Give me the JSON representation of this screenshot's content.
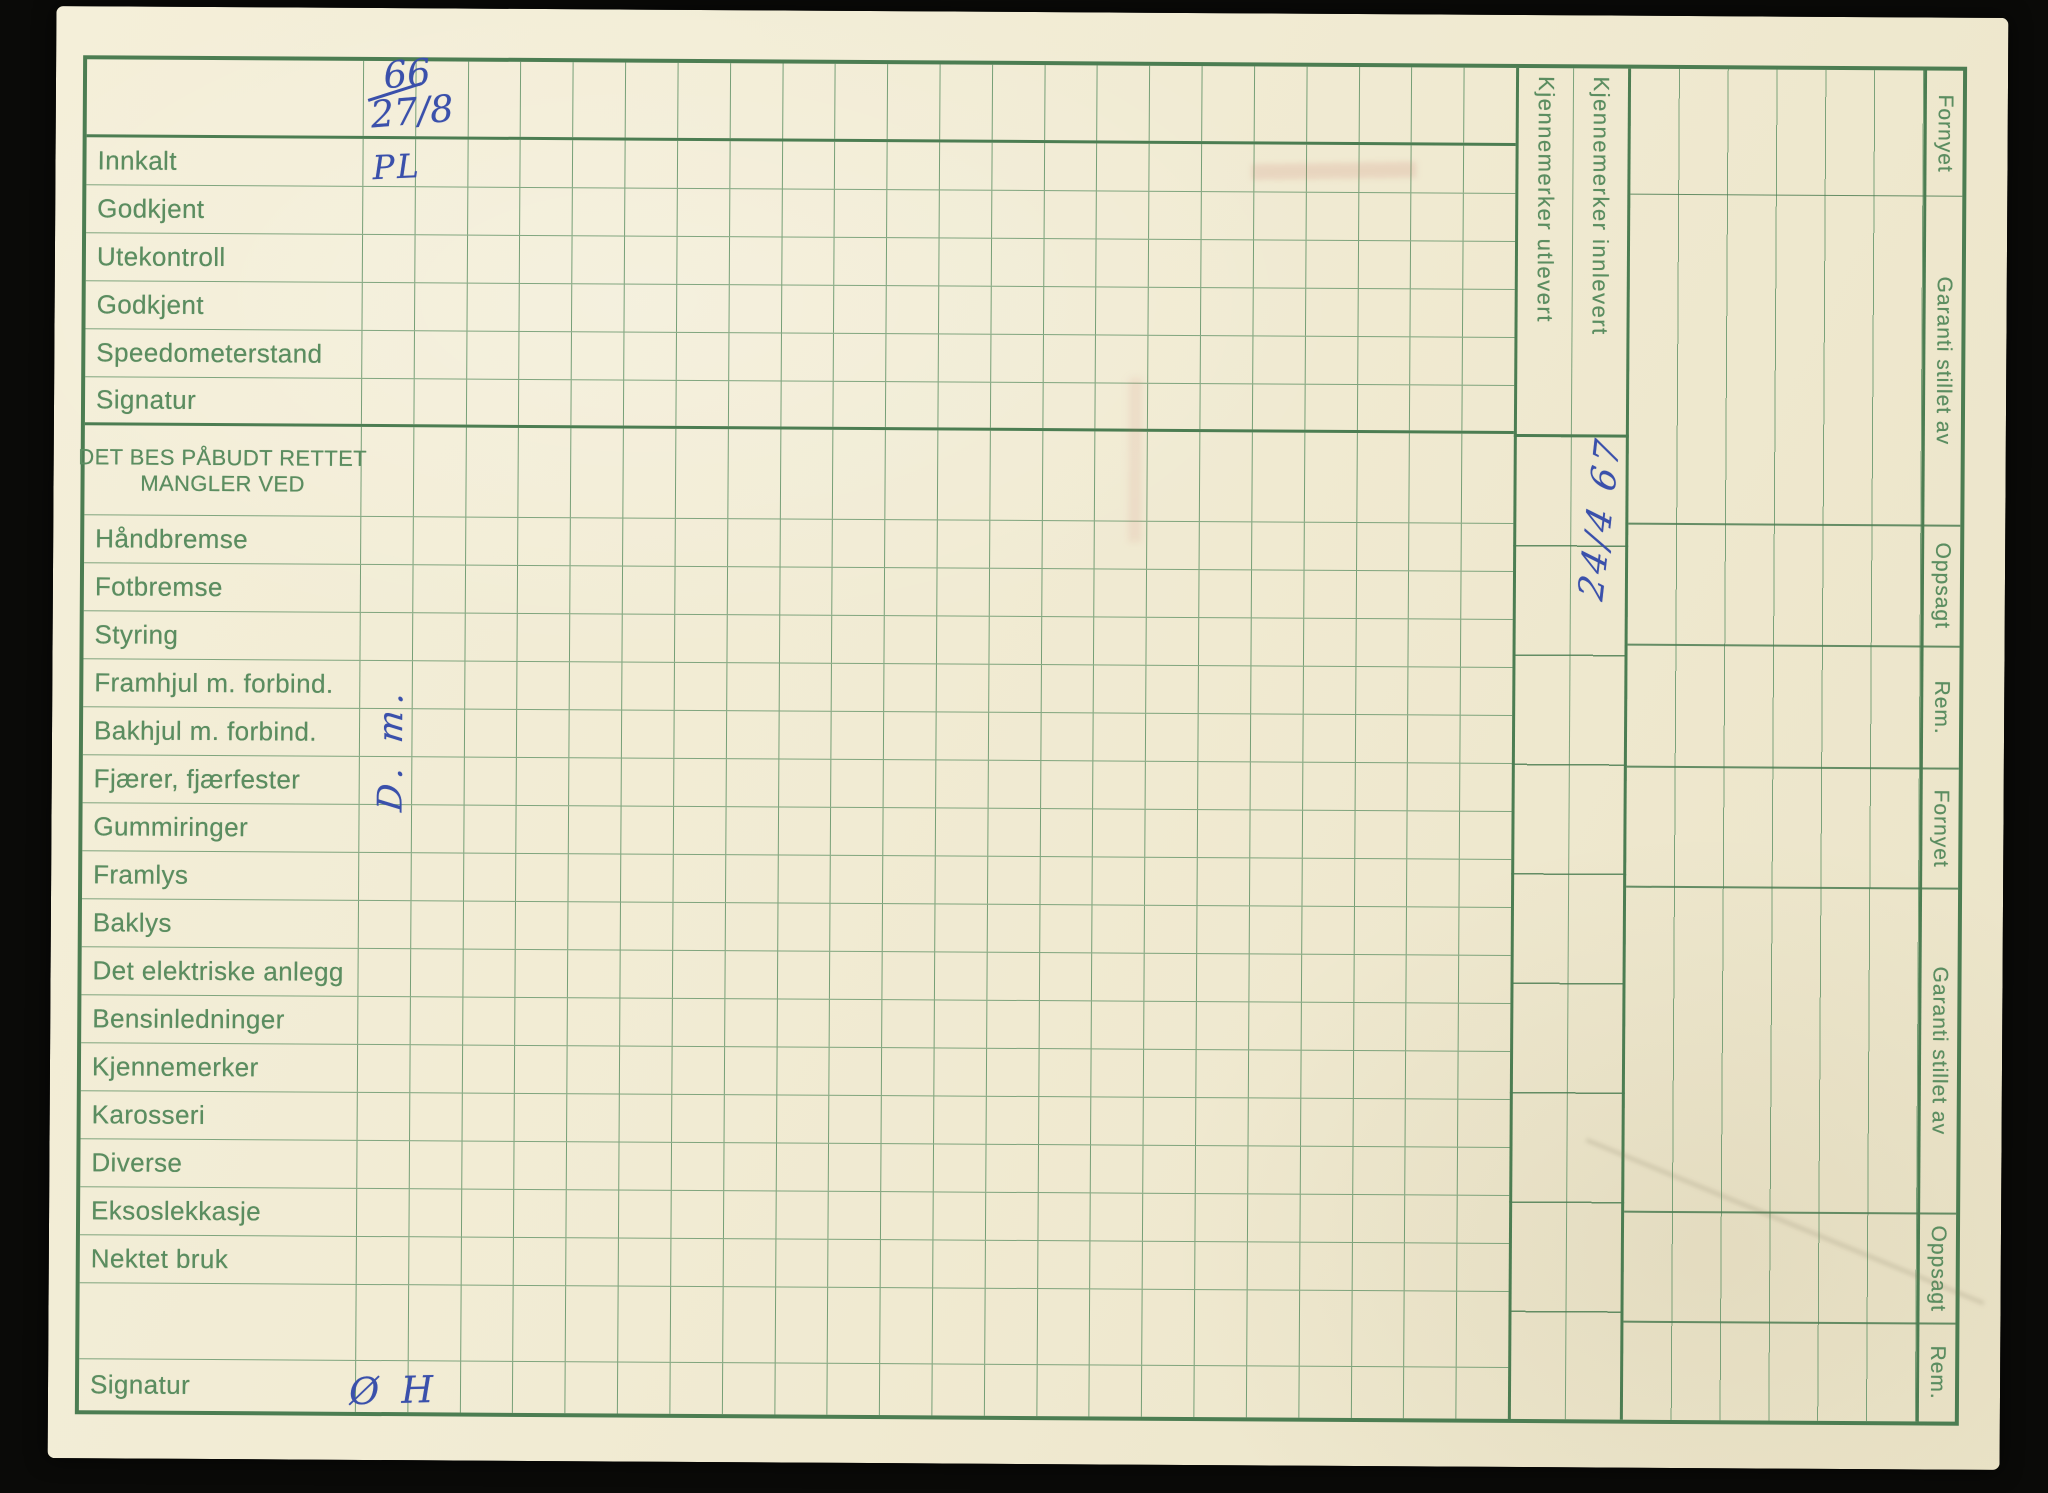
{
  "document": {
    "kind": "vehicle-inspection-record-card",
    "language": "Norwegian"
  },
  "colors": {
    "scan_background": "#0a0a08",
    "paper": "#f1ebd3",
    "grid_line": "#609165",
    "grid_line_dark": "#4c7d52",
    "label_green": "#5b8d60",
    "ink_blue": "#3a50ab"
  },
  "rows": [
    {
      "label": "Innkalt"
    },
    {
      "label": "Godkjent"
    },
    {
      "label": "Utekontroll"
    },
    {
      "label": "Godkjent"
    },
    {
      "label": "Speedometerstand"
    },
    {
      "label": "Signatur"
    },
    {
      "label": "Håndbremse"
    },
    {
      "label": "Fotbremse"
    },
    {
      "label": "Styring"
    },
    {
      "label": "Framhjul m. forbind."
    },
    {
      "label": "Bakhjul m. forbind."
    },
    {
      "label": "Fjærer, fjærfester"
    },
    {
      "label": "Gummiringer"
    },
    {
      "label": "Framlys"
    },
    {
      "label": "Baklys"
    },
    {
      "label": "Det elektriske anlegg"
    },
    {
      "label": "Bensinledninger"
    },
    {
      "label": "Kjennemerker"
    },
    {
      "label": "Karosseri"
    },
    {
      "label": "Diverse"
    },
    {
      "label": "Eksoslekkasje"
    },
    {
      "label": "Nektet bruk"
    },
    {
      "label": ""
    },
    {
      "label": "Signatur"
    }
  ],
  "section_header": {
    "line1": "DET BES PÅBUDT RETTET",
    "line2": "MANGLER VED"
  },
  "kjenn_columns": {
    "utlevert": "Kjennemerker utlevert",
    "innlevert": "Kjennemerker innlevert"
  },
  "right_labels": [
    {
      "text": "Fornyet"
    },
    {
      "text": "Garanti stillet av"
    },
    {
      "text": "Oppsagt"
    },
    {
      "text": "Rem."
    },
    {
      "text": "Fornyet"
    },
    {
      "text": "Garanti stillet av"
    },
    {
      "text": "Oppsagt"
    },
    {
      "text": "Rem."
    }
  ],
  "handwriting": {
    "top_number": "66",
    "top_date": "27/8",
    "innkalt_initials": "PL",
    "checklist_initials": "D. m.",
    "kjennemerker_date": "24/4 67",
    "signature_initials": "Ø H"
  }
}
